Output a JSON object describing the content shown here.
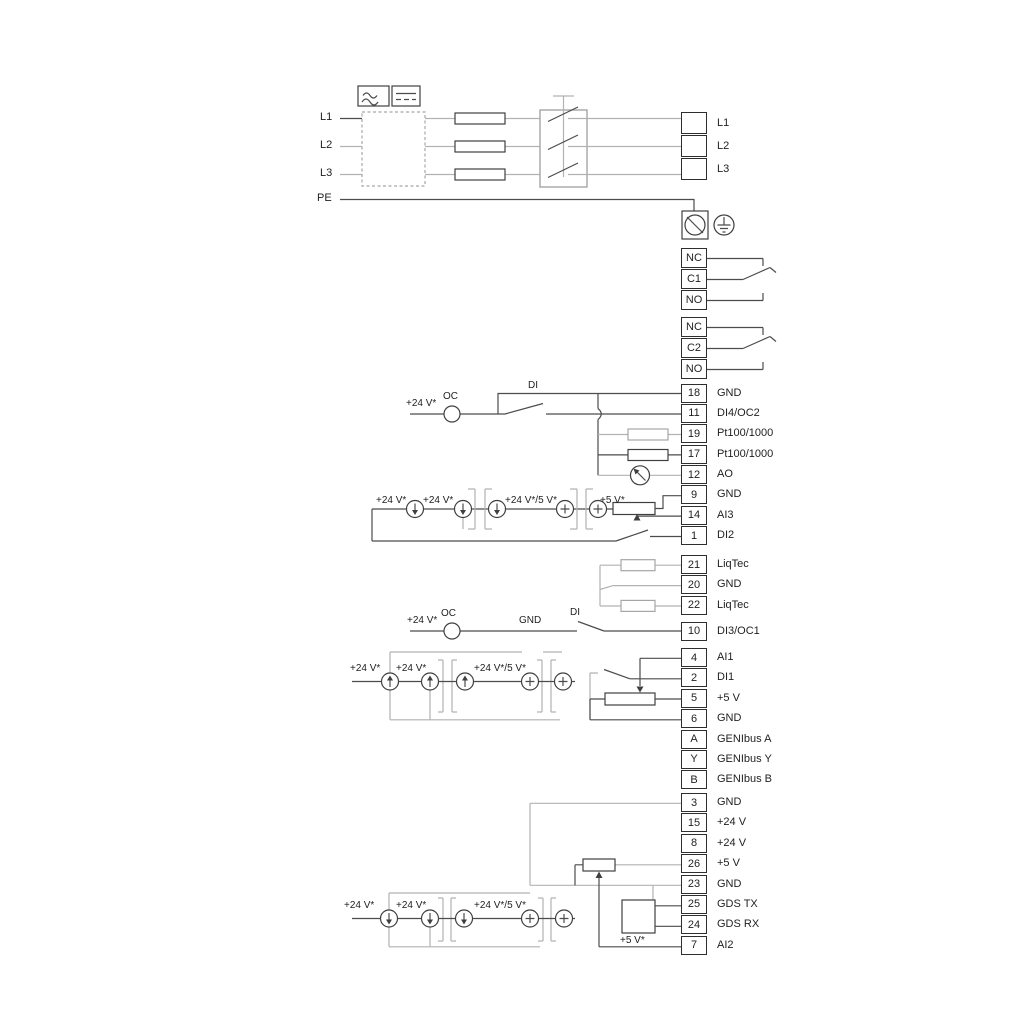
{
  "colors": {
    "wire_dark": "#4c4c4c",
    "wire_gray": "#b2b2b2",
    "text": "#1f1f1f",
    "background": "#ffffff"
  },
  "power": {
    "inputs": [
      "L1",
      "L2",
      "L3",
      "PE"
    ],
    "outputs": [
      {
        "l": "L1"
      },
      {
        "l": "L2"
      },
      {
        "l": "L3"
      }
    ]
  },
  "relays": {
    "relay1": [
      {
        "n": "NC"
      },
      {
        "n": "C1"
      },
      {
        "n": "NO"
      }
    ],
    "relay2": [
      {
        "n": "NC"
      },
      {
        "n": "C2"
      },
      {
        "n": "NO"
      }
    ]
  },
  "terminals": {
    "strip_a": [
      {
        "n": "18",
        "l": "GND"
      },
      {
        "n": "11",
        "l": "DI4/OC2"
      },
      {
        "n": "19",
        "l": "Pt100/1000"
      },
      {
        "n": "17",
        "l": "Pt100/1000"
      },
      {
        "n": "12",
        "l": "AO"
      },
      {
        "n": "9",
        "l": "GND"
      },
      {
        "n": "14",
        "l": "AI3"
      },
      {
        "n": "1",
        "l": "DI2"
      }
    ],
    "strip_liqtec": [
      {
        "n": "21",
        "l": "LiqTec"
      },
      {
        "n": "20",
        "l": "GND"
      },
      {
        "n": "22",
        "l": "LiqTec"
      }
    ],
    "strip_di3": [
      {
        "n": "10",
        "l": "DI3/OC1"
      }
    ],
    "strip_mid": [
      {
        "n": "4",
        "l": "AI1"
      },
      {
        "n": "2",
        "l": "DI1"
      },
      {
        "n": "5",
        "l": "+5 V"
      },
      {
        "n": "6",
        "l": "GND"
      },
      {
        "n": "A",
        "l": "GENIbus A"
      },
      {
        "n": "Y",
        "l": "GENIbus Y"
      },
      {
        "n": "B",
        "l": "GENIbus B"
      }
    ],
    "strip_bottom": [
      {
        "n": "3",
        "l": "GND"
      },
      {
        "n": "15",
        "l": "+24 V"
      },
      {
        "n": "8",
        "l": "+24 V"
      },
      {
        "n": "26",
        "l": "+5 V"
      },
      {
        "n": "23",
        "l": "GND"
      },
      {
        "n": "25",
        "l": "GDS TX"
      },
      {
        "n": "24",
        "l": "GDS RX"
      },
      {
        "n": "7",
        "l": "AI2"
      }
    ]
  },
  "wire_labels": {
    "v24": "+24 V*",
    "v24_5": "+24 V*/5 V*",
    "v5": "+5 V*",
    "oc": "OC",
    "di": "DI",
    "gnd": "GND"
  },
  "icons": [
    "ac-symbol-icon",
    "dc-symbol-icon",
    "emc-filter-box",
    "fuse-icon",
    "disconnect-switch-icon",
    "pe-screw-terminal-icon",
    "earth-ground-icon",
    "relay-changeover-contact-icon",
    "open-collector-icon",
    "digital-input-switch-icon",
    "resistor-icon",
    "analog-output-meter-icon",
    "current-source-icon",
    "potentiometer-icon",
    "gds-sensor-box-icon"
  ]
}
